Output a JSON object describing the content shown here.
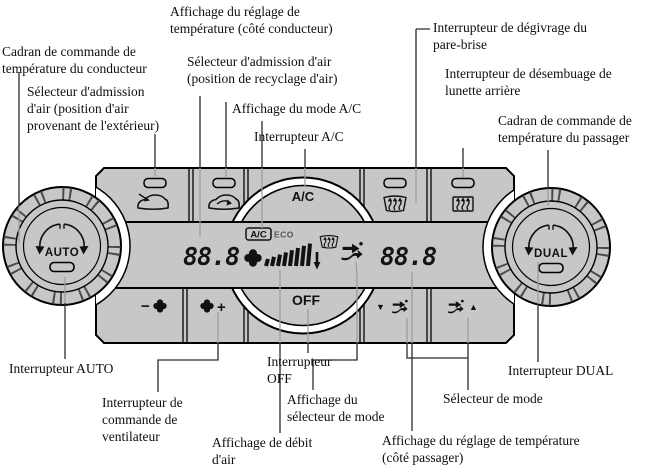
{
  "panel": {
    "bg_color": "#c7c7c7",
    "knob_left": {
      "label": "AUTO"
    },
    "knob_right": {
      "label": "DUAL"
    },
    "ac_button": "A/C",
    "off_button": "OFF",
    "fan_minus": "−",
    "fan_plus": "+",
    "mode_down": "▼",
    "mode_up": "▲",
    "display": {
      "driver_temp": "88.8",
      "passenger_temp": "88.8",
      "ac_indicator": "A/C",
      "eco_indicator": "ECO"
    }
  },
  "line_colors": {
    "outside_panel": "#2b2b2b",
    "over_panel": "#9e9e9e"
  },
  "callouts": [
    {
      "text": "Affichage du réglage de\ntempérature (côté conducteur)"
    },
    {
      "text": "Cadran de commande de\ntempérature du conducteur"
    },
    {
      "text": "Sélecteur d'admission\nd'air (position d'air\nprovenant de l'extérieur)"
    },
    {
      "text": "Sélecteur d'admission d'air\n(position de recyclage d'air)"
    },
    {
      "text": "Affichage du mode A/C"
    },
    {
      "text": "Interrupteur A/C"
    },
    {
      "text": "Interrupteur de dégivrage du\npare-brise"
    },
    {
      "text": "Interrupteur de désembuage de\nlunette arrière"
    },
    {
      "text": "Cadran de commande de\ntempérature du passager"
    },
    {
      "text": "Interrupteur AUTO"
    },
    {
      "text": "Interrupteur de\ncommande de\nventilateur"
    },
    {
      "text": "Interrupteur\nOFF"
    },
    {
      "text": "Affichage de débit\nd'air"
    },
    {
      "text": "Affichage du\nsélecteur de mode"
    },
    {
      "text": "Affichage du réglage de température\n(côté passager)"
    },
    {
      "text": "Sélecteur de mode"
    },
    {
      "text": "Interrupteur DUAL"
    }
  ]
}
